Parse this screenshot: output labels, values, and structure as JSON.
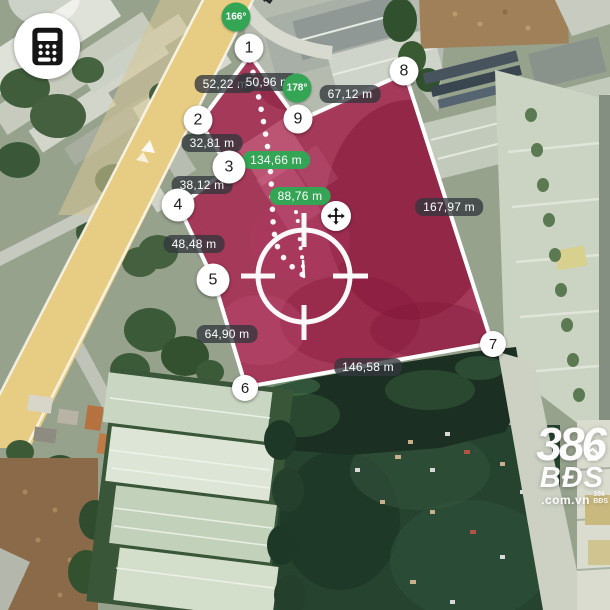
{
  "screen": {
    "width": 610,
    "height": 610
  },
  "map": {
    "type": "satellite",
    "street_label": "Đ. Q"
  },
  "toolbar": {
    "calculator_button_icon": "calculator-icon"
  },
  "measurement": {
    "vertex_markers": [
      "1",
      "2",
      "3",
      "4",
      "5",
      "6",
      "7",
      "8",
      "9"
    ],
    "edge_distance_labels": [
      "52,22 m",
      "50,96 m",
      "67,12 m",
      "32,81 m",
      "38,12 m",
      "48,48 m",
      "167,97 m",
      "64,90 m",
      "146,58 m"
    ],
    "guide_distance_labels": [
      "134,66 m",
      "88,76 m"
    ],
    "angle_labels": [
      "166°",
      "178°"
    ],
    "icons": {
      "move": "move-icon",
      "crosshair": "crosshair-reticle-icon",
      "calculator": "calculator-icon"
    },
    "colors": {
      "parcel_fill": "#a62a52",
      "parcel_stroke": "#ffffff",
      "distance_pill_bg": "rgba(50,55,60,0.78)",
      "green_badge_bg": "#34a455",
      "marker_bg": "#ffffff",
      "road_yellow": "#e7cc83"
    }
  },
  "watermark": {
    "brand_number": "386",
    "brand_text": "BĐS",
    "domain_suffix": ".com.vn"
  }
}
